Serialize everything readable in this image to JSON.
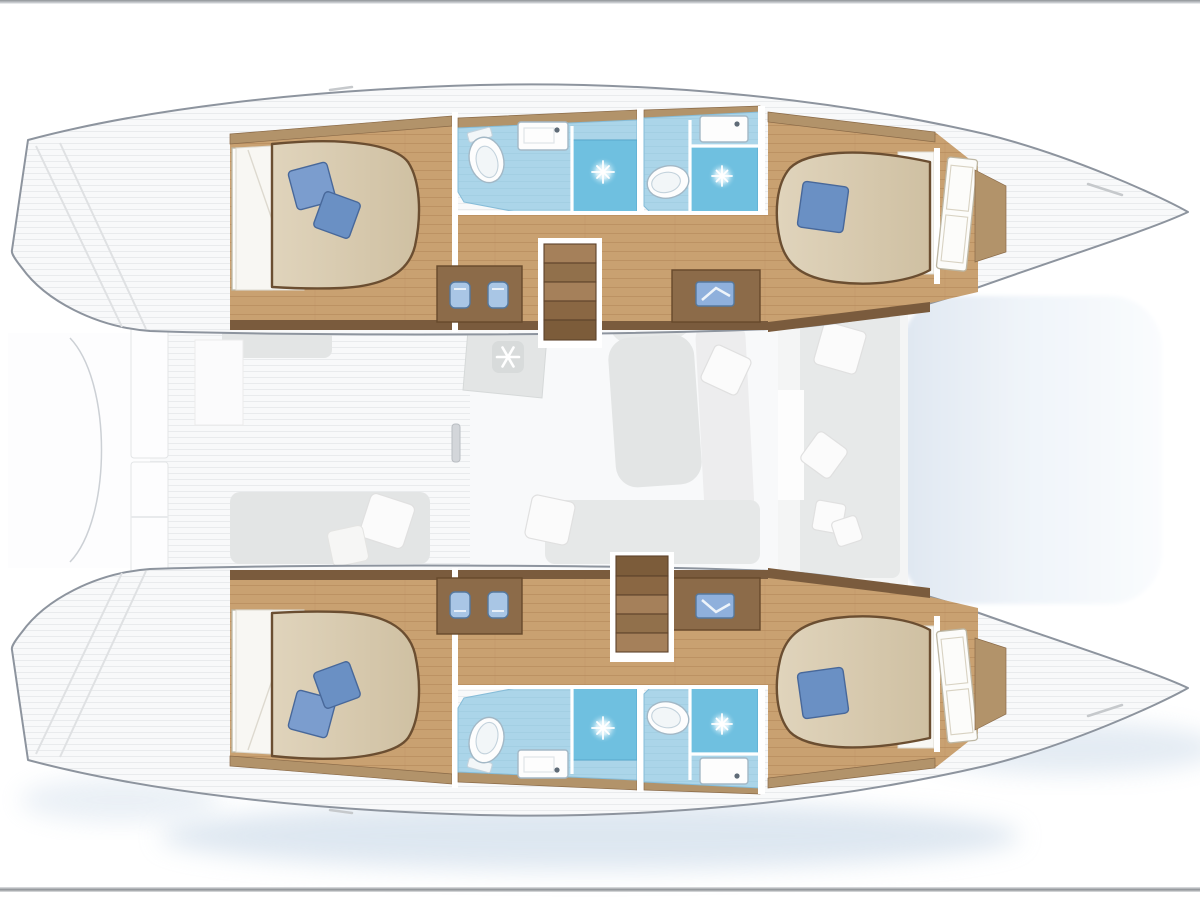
{
  "page": {
    "description": "Catamaran sailing yacht interior layout plan, top view, bows to the right",
    "visible_text": "",
    "top_divider": true,
    "bottom_divider": true
  },
  "colors": {
    "deck": "#f8f9fa",
    "deckStripe": "#e9ebed",
    "hullLine": "#8d949e",
    "wood": "#c9a171",
    "woodSeam": "#b08355",
    "woodDark": "#7a5b3d",
    "woodTrim": "#b2936a",
    "furnitureWood": "#8c6b49",
    "furnitureWoodEdge": "#67492c",
    "bathFloor": "#abd5e9",
    "bathEdge": "#86bcd8",
    "shower": "#6fc0e0",
    "showerEdge": "#58a9cc",
    "bed": "#d8cbb1",
    "bedEdge": "#6b4e31",
    "sheet": "#f8f7f3",
    "pillowBlue": "#6a90c4",
    "pillowBlueLight": "#7b9dce",
    "pillowEdge": "#48689a",
    "stool": "#a9c6e5",
    "stoolEdge": "#55799f",
    "grayFurniture": "#e3e5e5",
    "grayFurnitureDark": "#d2d5d5",
    "whitePillow": "#fbfbfb",
    "trampolineLight": "#fafcfe",
    "trampolineDark": "#dfe7f1",
    "waterShadow": "#c3d4e5",
    "dividerDark": "#8f9397",
    "dividerLight": "#d7dadd",
    "fixtureOutline": "#a3b8c6"
  },
  "diagram": {
    "type": "yacht-floor-plan",
    "vessel": "catamaran",
    "orientation": {
      "bow": "right",
      "stern": "left",
      "port_hull": "top",
      "starboard_hull": "bottom"
    },
    "hulls": [
      {
        "id": "port",
        "position": "top",
        "rooms": [
          {
            "id": "cabin-port-aft",
            "type": "double-cabin",
            "features": [
              "island-double-bed",
              "two-blue-pillows",
              "headboard-shelving"
            ]
          },
          {
            "id": "head-port-aft",
            "type": "bathroom",
            "features": [
              "toilet",
              "washbasin",
              "shower-stall"
            ]
          },
          {
            "id": "vanity-port-aft",
            "type": "vanity-desk",
            "features": [
              "two-blue-stools"
            ]
          },
          {
            "id": "stairs-port",
            "type": "companionway-steps",
            "steps": 5
          },
          {
            "id": "desk-port-fwd",
            "type": "chart-desk",
            "features": [
              "blue-basin"
            ]
          },
          {
            "id": "head-port-fwd",
            "type": "bathroom",
            "features": [
              "toilet",
              "washbasin",
              "shower-stall"
            ]
          },
          {
            "id": "cabin-port-fwd",
            "type": "double-cabin",
            "features": [
              "island-double-bed",
              "one-blue-pillow",
              "cabin-door"
            ]
          }
        ]
      },
      {
        "id": "starboard",
        "position": "bottom",
        "mirrored_from": "port",
        "rooms": [
          {
            "id": "cabin-starboard-aft",
            "type": "double-cabin",
            "features": [
              "island-double-bed",
              "two-blue-pillows",
              "headboard-shelving"
            ]
          },
          {
            "id": "head-starboard-aft",
            "type": "bathroom",
            "features": [
              "toilet",
              "washbasin",
              "shower-stall"
            ]
          },
          {
            "id": "vanity-starboard-aft",
            "type": "vanity-desk",
            "features": [
              "two-blue-stools"
            ]
          },
          {
            "id": "stairs-starboard",
            "type": "companionway-steps",
            "steps": 5
          },
          {
            "id": "desk-starboard-fwd",
            "type": "chart-desk",
            "features": [
              "blue-basin"
            ]
          },
          {
            "id": "head-starboard-fwd",
            "type": "bathroom",
            "features": [
              "toilet",
              "washbasin",
              "shower-stall"
            ]
          },
          {
            "id": "cabin-starboard-fwd",
            "type": "double-cabin",
            "features": [
              "island-double-bed",
              "one-blue-pillow",
              "cabin-door"
            ]
          }
        ]
      }
    ],
    "deck_features": {
      "aft_deck": [
        "transom-platform-port",
        "transom-platform-starboard",
        "aft-bench",
        "aft-sunpad-with-cushions",
        "storage-locker"
      ],
      "salon": [
        "galley-unit",
        "air-conditioning-snowflake",
        "settee",
        "seat-with-cushion"
      ],
      "forward_cockpit": [
        "bench-seat",
        "three-white-cushions"
      ],
      "foredeck": [
        "trampoline"
      ]
    },
    "icons": [
      "snowflake-icon",
      "shower-sparkle-icon"
    ]
  }
}
